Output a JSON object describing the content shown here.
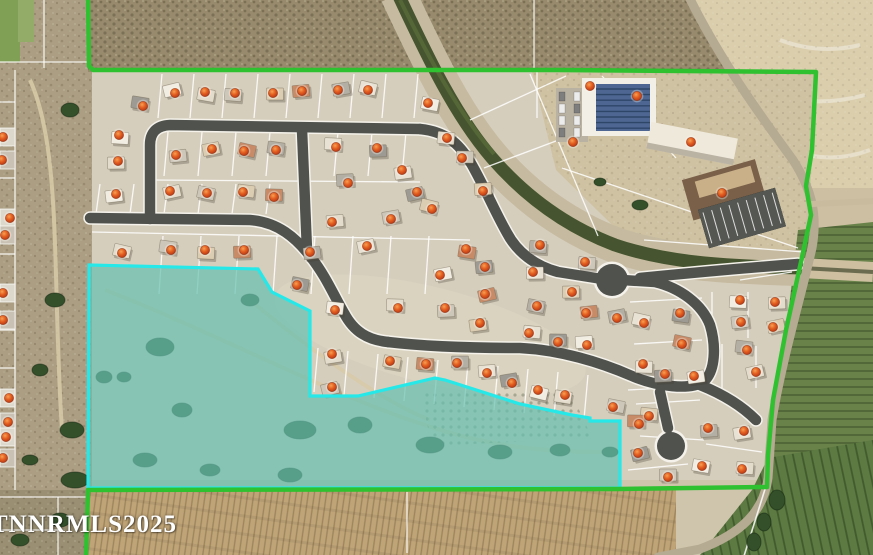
{
  "map": {
    "type": "aerial-parcel-map",
    "watermark": "TNNRMLS2025",
    "colors": {
      "boundary_green": "#2fc12f",
      "parcel_cyan": "#26e8e8",
      "parcel_cyan_fill": "rgba(38,196,188,0.42)",
      "marker_orange": "#e2571f",
      "canal_water": "#46552f",
      "asphalt": "#50524e"
    },
    "boundary_green_path": [
      [
        88,
        -2
      ],
      [
        89,
        66
      ],
      [
        93,
        70
      ],
      [
        558,
        70
      ],
      [
        816,
        72
      ],
      [
        812,
        150
      ],
      [
        806,
        186
      ],
      [
        811,
        215
      ],
      [
        801,
        262
      ],
      [
        786,
        330
      ],
      [
        773,
        400
      ],
      [
        768,
        455
      ],
      [
        767,
        487
      ],
      [
        618,
        489
      ],
      [
        88,
        490
      ],
      [
        86,
        557
      ]
    ],
    "highlight_cyan_polygon": [
      [
        89,
        265
      ],
      [
        258,
        269
      ],
      [
        272,
        292
      ],
      [
        310,
        311
      ],
      [
        310,
        396
      ],
      [
        358,
        396
      ],
      [
        435,
        378
      ],
      [
        445,
        380
      ],
      [
        520,
        404
      ],
      [
        572,
        415
      ],
      [
        590,
        418
      ],
      [
        590,
        421
      ],
      [
        620,
        421
      ],
      [
        620,
        488
      ],
      [
        88,
        488
      ]
    ],
    "markers": [
      [
        175,
        93
      ],
      [
        205,
        92
      ],
      [
        235,
        93
      ],
      [
        273,
        93
      ],
      [
        302,
        91
      ],
      [
        338,
        90
      ],
      [
        368,
        90
      ],
      [
        143,
        106
      ],
      [
        119,
        135
      ],
      [
        118,
        161
      ],
      [
        176,
        155
      ],
      [
        212,
        149
      ],
      [
        244,
        151
      ],
      [
        276,
        150
      ],
      [
        336,
        147
      ],
      [
        377,
        148
      ],
      [
        116,
        194
      ],
      [
        170,
        191
      ],
      [
        207,
        193
      ],
      [
        243,
        192
      ],
      [
        274,
        197
      ],
      [
        348,
        183
      ],
      [
        402,
        170
      ],
      [
        417,
        192
      ],
      [
        428,
        103
      ],
      [
        447,
        138
      ],
      [
        462,
        158
      ],
      [
        483,
        191
      ],
      [
        590,
        86
      ],
      [
        637,
        96
      ],
      [
        573,
        142
      ],
      [
        691,
        142
      ],
      [
        722,
        193
      ],
      [
        332,
        222
      ],
      [
        391,
        219
      ],
      [
        432,
        209
      ],
      [
        466,
        249
      ],
      [
        540,
        245
      ],
      [
        533,
        272
      ],
      [
        485,
        267
      ],
      [
        440,
        275
      ],
      [
        122,
        253
      ],
      [
        171,
        250
      ],
      [
        205,
        250
      ],
      [
        244,
        250
      ],
      [
        310,
        252
      ],
      [
        367,
        246
      ],
      [
        297,
        285
      ],
      [
        335,
        310
      ],
      [
        398,
        308
      ],
      [
        445,
        308
      ],
      [
        480,
        323
      ],
      [
        485,
        294
      ],
      [
        537,
        306
      ],
      [
        529,
        333
      ],
      [
        558,
        342
      ],
      [
        587,
        345
      ],
      [
        332,
        354
      ],
      [
        332,
        387
      ],
      [
        390,
        361
      ],
      [
        426,
        364
      ],
      [
        457,
        363
      ],
      [
        487,
        373
      ],
      [
        512,
        383
      ],
      [
        538,
        390
      ],
      [
        565,
        395
      ],
      [
        585,
        262
      ],
      [
        572,
        292
      ],
      [
        586,
        313
      ],
      [
        617,
        318
      ],
      [
        644,
        323
      ],
      [
        680,
        313
      ],
      [
        740,
        300
      ],
      [
        775,
        302
      ],
      [
        741,
        322
      ],
      [
        773,
        327
      ],
      [
        682,
        344
      ],
      [
        747,
        350
      ],
      [
        643,
        364
      ],
      [
        665,
        374
      ],
      [
        694,
        376
      ],
      [
        756,
        372
      ],
      [
        613,
        407
      ],
      [
        649,
        416
      ],
      [
        639,
        424
      ],
      [
        708,
        428
      ],
      [
        744,
        431
      ],
      [
        638,
        453
      ],
      [
        702,
        466
      ],
      [
        742,
        469
      ],
      [
        668,
        477
      ],
      [
        3,
        137
      ],
      [
        2,
        160
      ],
      [
        10,
        218
      ],
      [
        5,
        235
      ],
      [
        3,
        293
      ],
      [
        3,
        320
      ],
      [
        9,
        398
      ],
      [
        8,
        422
      ],
      [
        6,
        437
      ],
      [
        3,
        458
      ]
    ]
  }
}
